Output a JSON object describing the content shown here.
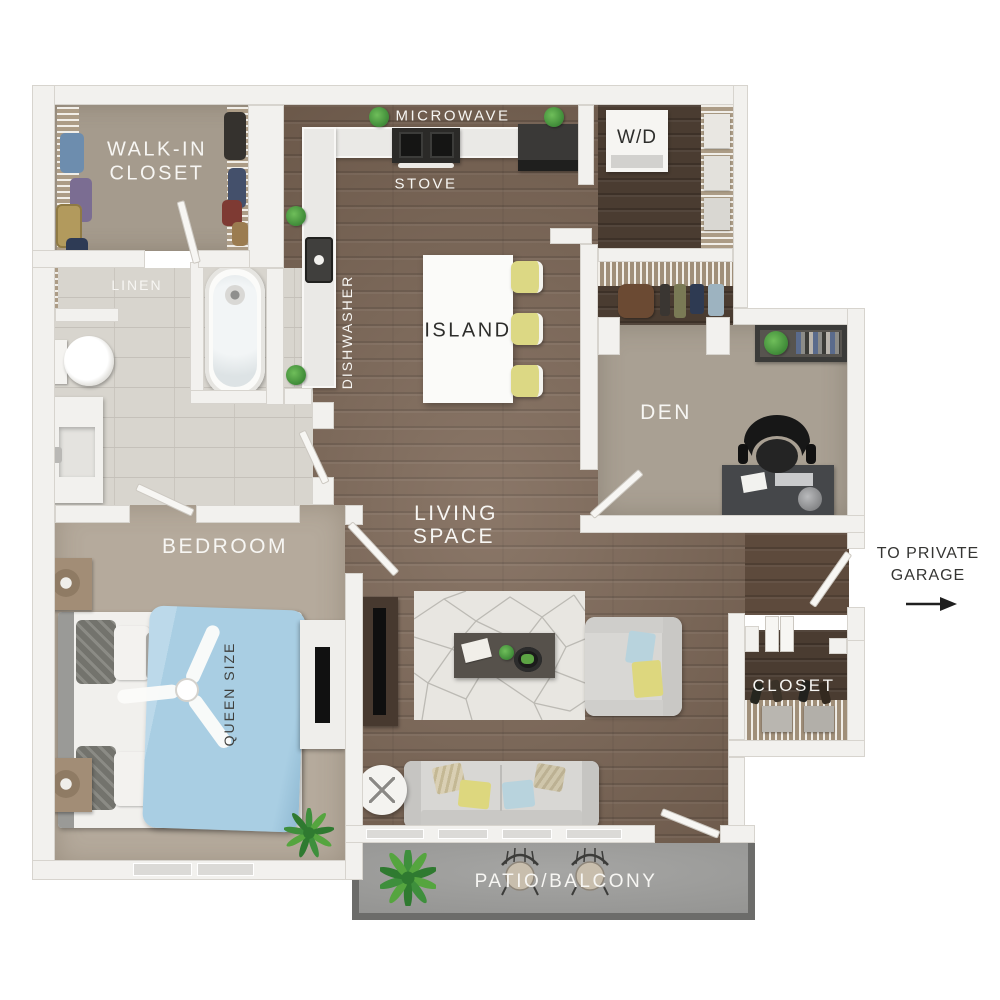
{
  "labels": {
    "walk_in_closet_line1": "WALK-IN",
    "walk_in_closet_line2": "CLOSET",
    "linen": "LINEN",
    "microwave": "MICROWAVE",
    "stove": "STOVE",
    "washer_dryer": "W/D",
    "dishwasher": "DISHWASHER",
    "island": "ISLAND",
    "den": "DEN",
    "living_line1": "LIVING",
    "living_line2": "SPACE",
    "bedroom": "BEDROOM",
    "queen_size": "QUEEN SIZE",
    "garage_line1": "TO PRIVATE",
    "garage_line2": "GARAGE",
    "entry_closet": "CLOSET",
    "patio": "PATIO/BALCONY"
  },
  "colors": {
    "wall": "#f2f1ee",
    "wall_line": "#d7d4ce",
    "wood": "#7a6453",
    "wood_dark": "#4a3c31",
    "wood_entry": "#5d4a3c",
    "carpet_bedroom": "#b5aa9c",
    "carpet_closet": "#a59b8d",
    "carpet_den": "#a9a093",
    "tile": "#d8d5ce",
    "tile_line": "#c5c1ba",
    "patio": "#9e9e9c",
    "patio_border": "#6c6c6a",
    "island": "#fbfbf9",
    "stool": "#dcd884",
    "bed_blue": "#a9cee3",
    "sofa": "#d8d7d4",
    "rug": "#e8e6e1",
    "dark_furniture": "#45474a",
    "plant": "#3f8a38",
    "label_light": "#f7f6f3",
    "label_dark": "#2e2e2c"
  }
}
